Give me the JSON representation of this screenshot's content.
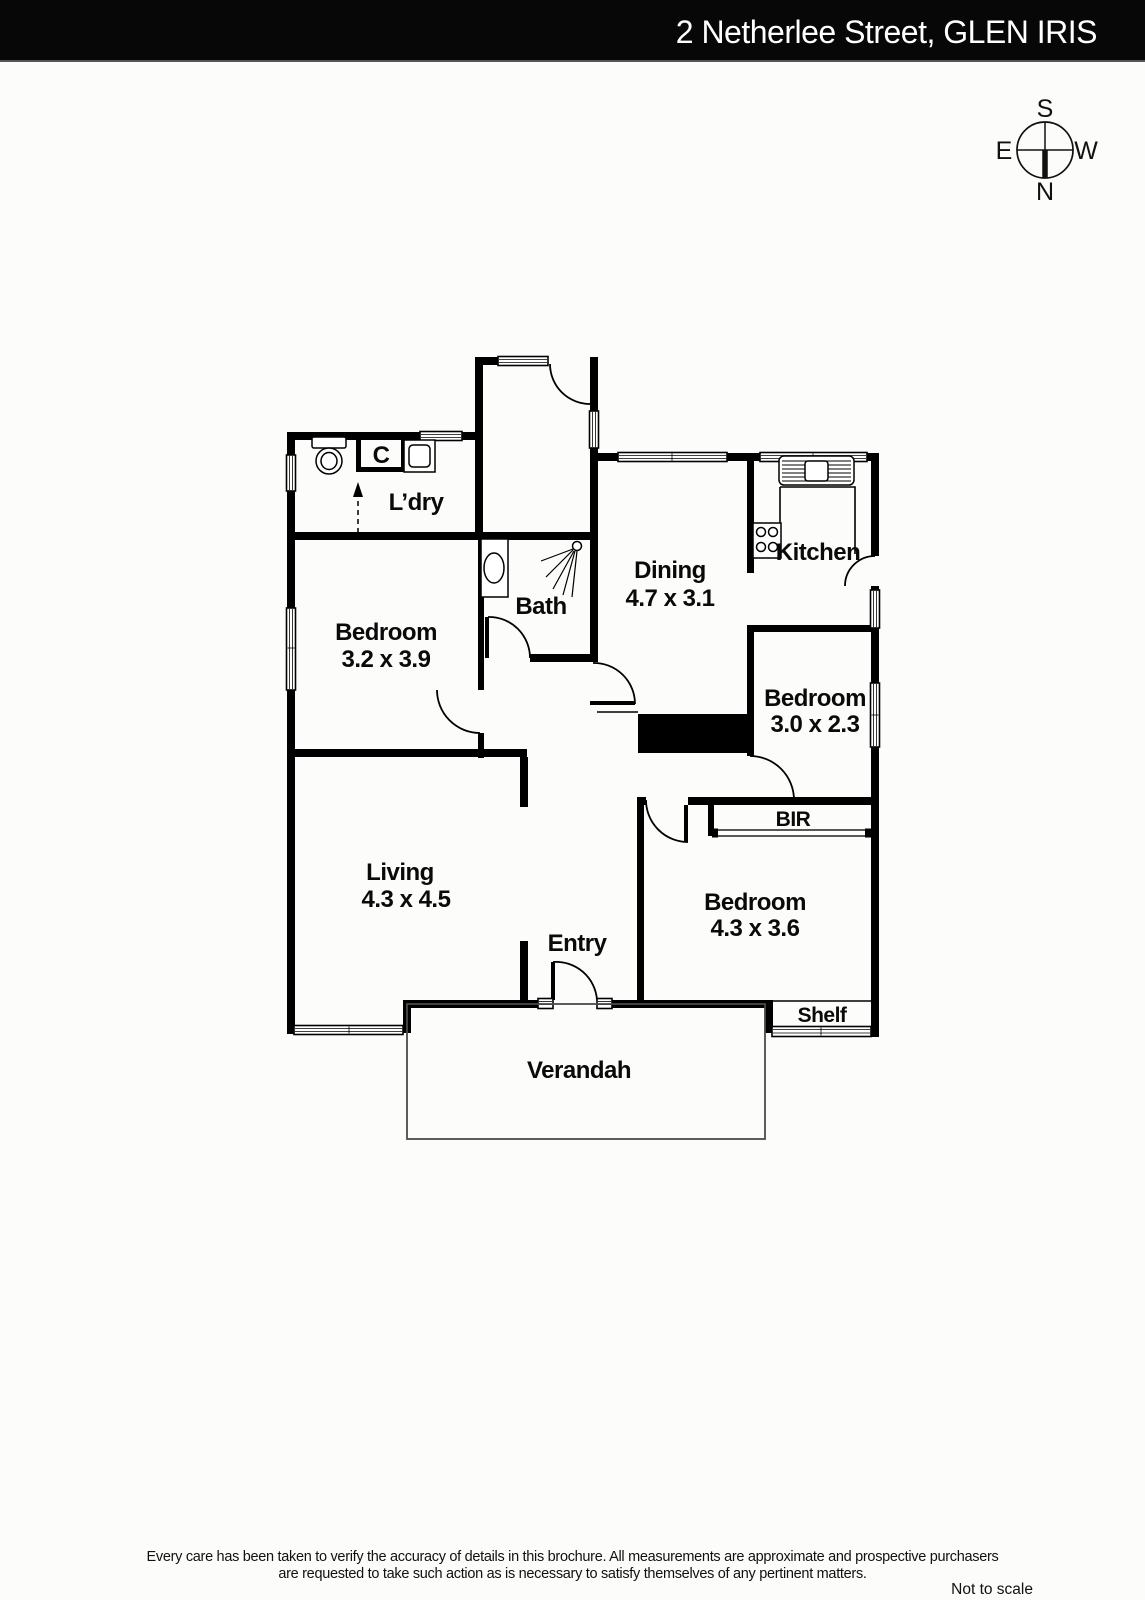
{
  "header": {
    "title": "2 Netherlee Street, GLEN IRIS"
  },
  "compass": {
    "north": "N",
    "south": "S",
    "east": "E",
    "west": "W"
  },
  "rooms": {
    "laundry": {
      "label": "L’dry"
    },
    "cupboard": {
      "label": "C"
    },
    "bath": {
      "label": "Bath"
    },
    "dining": {
      "label": "Dining",
      "dims": "4.7 x 3.1"
    },
    "kitchen": {
      "label": "Kitchen"
    },
    "bedroom_left": {
      "label": "Bedroom",
      "dims": "3.2 x 3.9"
    },
    "bedroom_middle": {
      "label": "Bedroom",
      "dims": "3.0 x 2.3"
    },
    "bedroom_front": {
      "label": "Bedroom",
      "dims": "4.3 x 3.6"
    },
    "bir": {
      "label": "BIR"
    },
    "living": {
      "label": "Living",
      "dims": "4.3 x 4.5"
    },
    "entry": {
      "label": "Entry"
    },
    "shelf": {
      "label": "Shelf"
    },
    "verandah": {
      "label": "Verandah"
    }
  },
  "footer": {
    "disclaimer_line1": "Every care has been taken to verify the accuracy of details in this brochure.  All measurements are approximate and prospective purchasers",
    "disclaimer_line2": "are requested to take such action as is necessary to satisfy themselves of any pertinent matters.",
    "scale_note": "Not to scale"
  },
  "colors": {
    "wall": "#000000",
    "header_bg": "#070707",
    "page_bg": "#fcfcfa"
  }
}
